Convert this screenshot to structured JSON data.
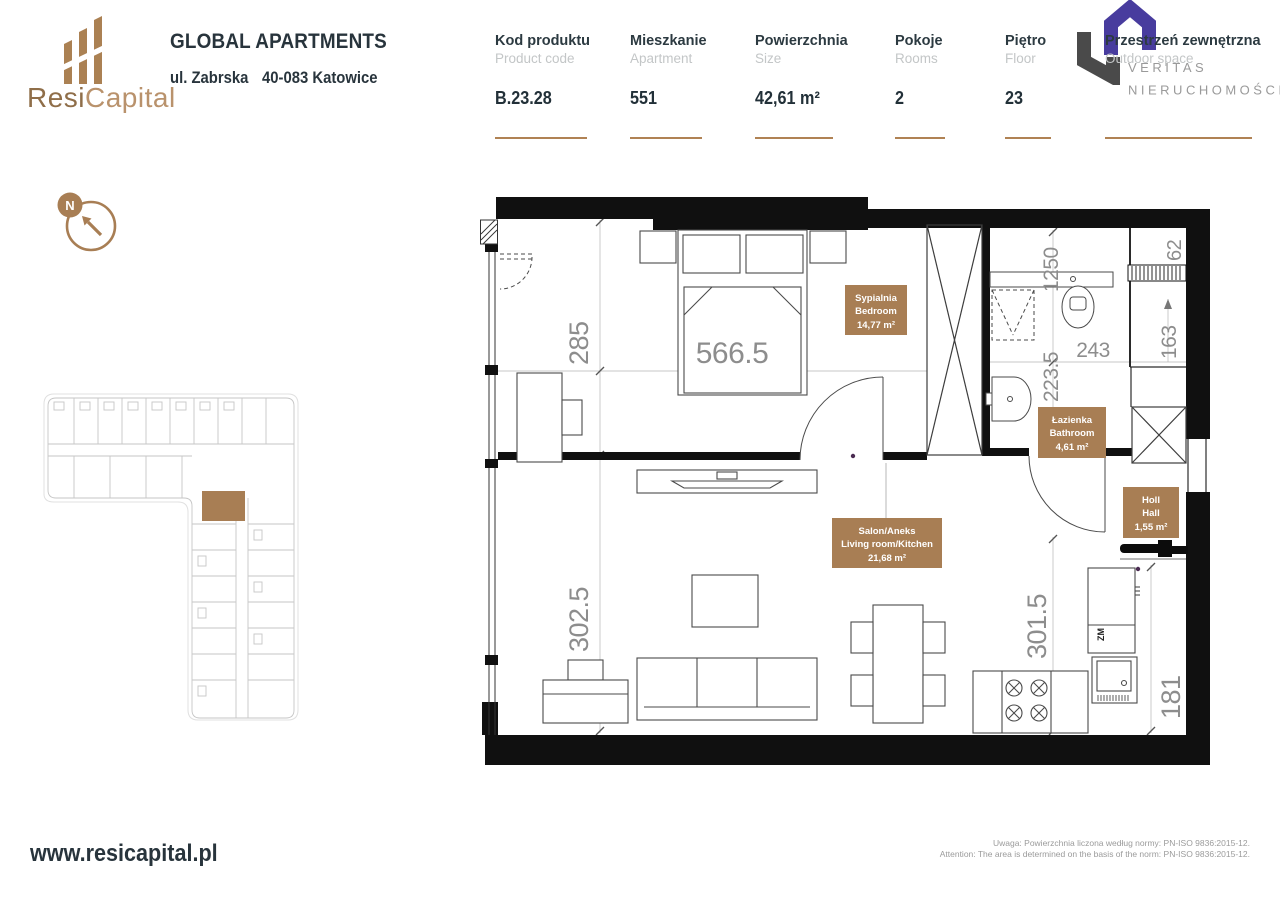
{
  "header": {
    "brand": {
      "name_primary": "Resi",
      "name_secondary": "Capital"
    },
    "project_title": "GLOBAL APARTMENTS",
    "address_line1": "ul. Zabrska",
    "address_line2": "40-083 Katowice",
    "info_columns": [
      {
        "label_pl": "Kod produktu",
        "label_en": "Product code",
        "value": "B.23.28"
      },
      {
        "label_pl": "Mieszkanie",
        "label_en": "Apartment",
        "value": "551"
      },
      {
        "label_pl": "Powierzchnia",
        "label_en": "Size",
        "value": "42,61 m²"
      },
      {
        "label_pl": "Pokoje",
        "label_en": "Rooms",
        "value": "2"
      },
      {
        "label_pl": "Piętro",
        "label_en": "Floor",
        "value": "23"
      },
      {
        "label_pl": "Przestrzeń zewnętrzna",
        "label_en": "Outdoor space",
        "value": ""
      }
    ],
    "partner": {
      "line1": "VERITAS",
      "line2": "NIERUCHOMOŚCI",
      "registered": "®"
    }
  },
  "compass": {
    "north": "N"
  },
  "floor_plan": {
    "room_labels": [
      {
        "name_pl": "Sypialnia",
        "name_en": "Bedroom",
        "area": "14,77 m²"
      },
      {
        "name_pl": "Łazienka",
        "name_en": "Bathroom",
        "area": "4,61 m²"
      },
      {
        "name_pl": "Holl",
        "name_en": "Hall",
        "area": "1,55 m²"
      },
      {
        "name_pl": "Salon/Aneks",
        "name_en": "Living room/Kitchen",
        "area": "21,68 m²"
      }
    ],
    "dimensions": {
      "bedroom_depth": "285",
      "bedroom_width": "566.5",
      "living_depth": "302.5",
      "bath_top": "1250",
      "bath_depth": "223.5",
      "bath_width": "243",
      "corridor_width": "163",
      "top_right": "62",
      "kitchen_depth": "301.5",
      "kitchen_width": "181"
    },
    "appliances": {
      "freezer": "ZM"
    }
  },
  "footer": {
    "website": "www.resicapital.pl",
    "note_pl": "Uwaga: Powierzchnia liczona według normy: PN-ISO 9836:2015-12.",
    "note_en": "Attention: The area is determined on the basis of the norm: PN-ISO 9836:2015-12."
  },
  "colors": {
    "accent": "#a87e54",
    "ink": "#2c3a41",
    "muted_gray": "#c3c6c7",
    "dim_text": "#8d8d8d",
    "partner_purple": "#483c9e",
    "partner_gray": "#4a4a4a"
  }
}
